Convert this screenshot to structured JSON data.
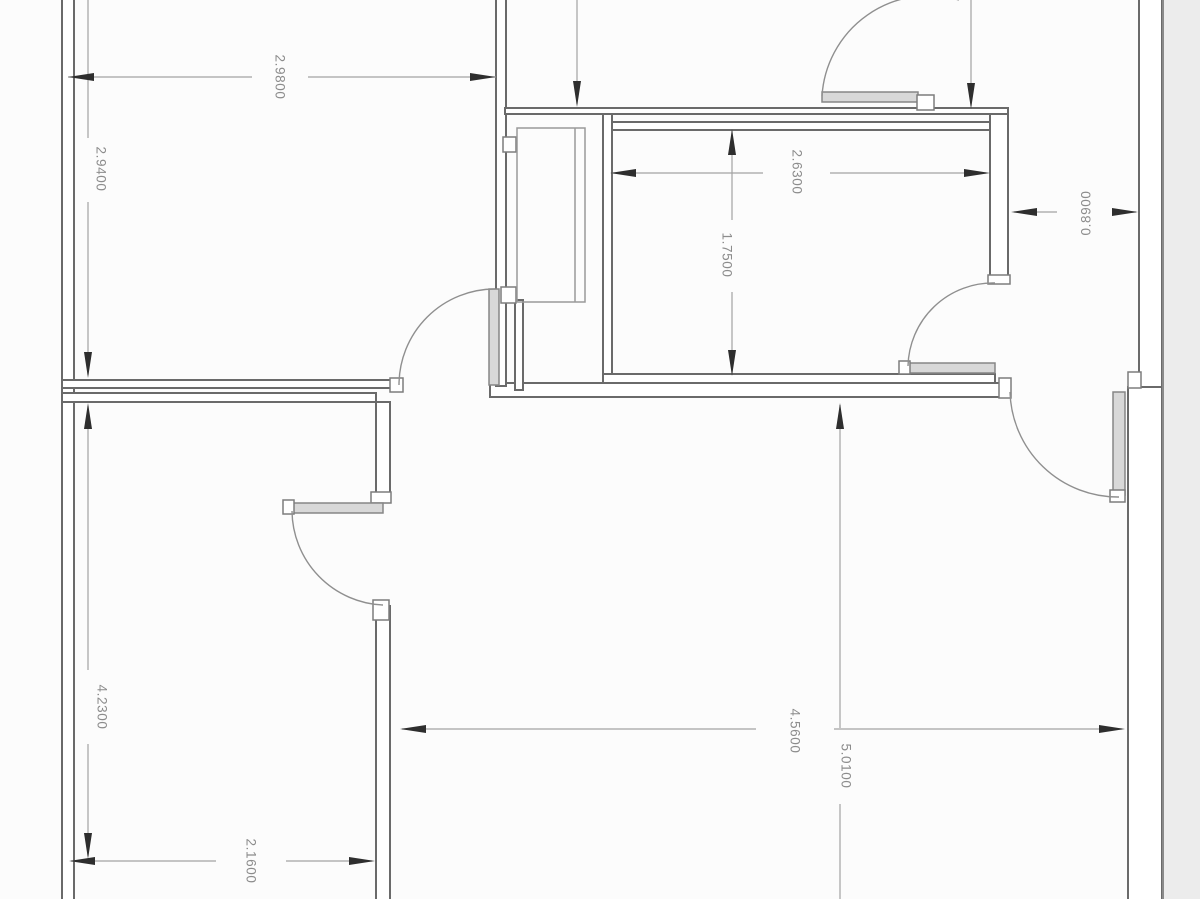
{
  "drawing": {
    "dimensions": {
      "top_width": "2.9800",
      "upper_left_height": "2.9400",
      "bedroom_width": "2.6300",
      "bedroom_height": "1.7500",
      "right_offset": "0.8900",
      "lower_left_height": "4.2300",
      "bottom_width": "2.1600",
      "living_width": "4.5600",
      "living_height": "5.0100"
    }
  },
  "colors": {
    "background": "#fcfcfc",
    "page_margin": "#ececec",
    "wall_line": "#6a6a6a",
    "dimension_line": "#a3a3a3",
    "arrowhead": "#2e2e2e",
    "label_text": "#8c8c8c",
    "door_leaf_fill": "#d8d8d8"
  }
}
